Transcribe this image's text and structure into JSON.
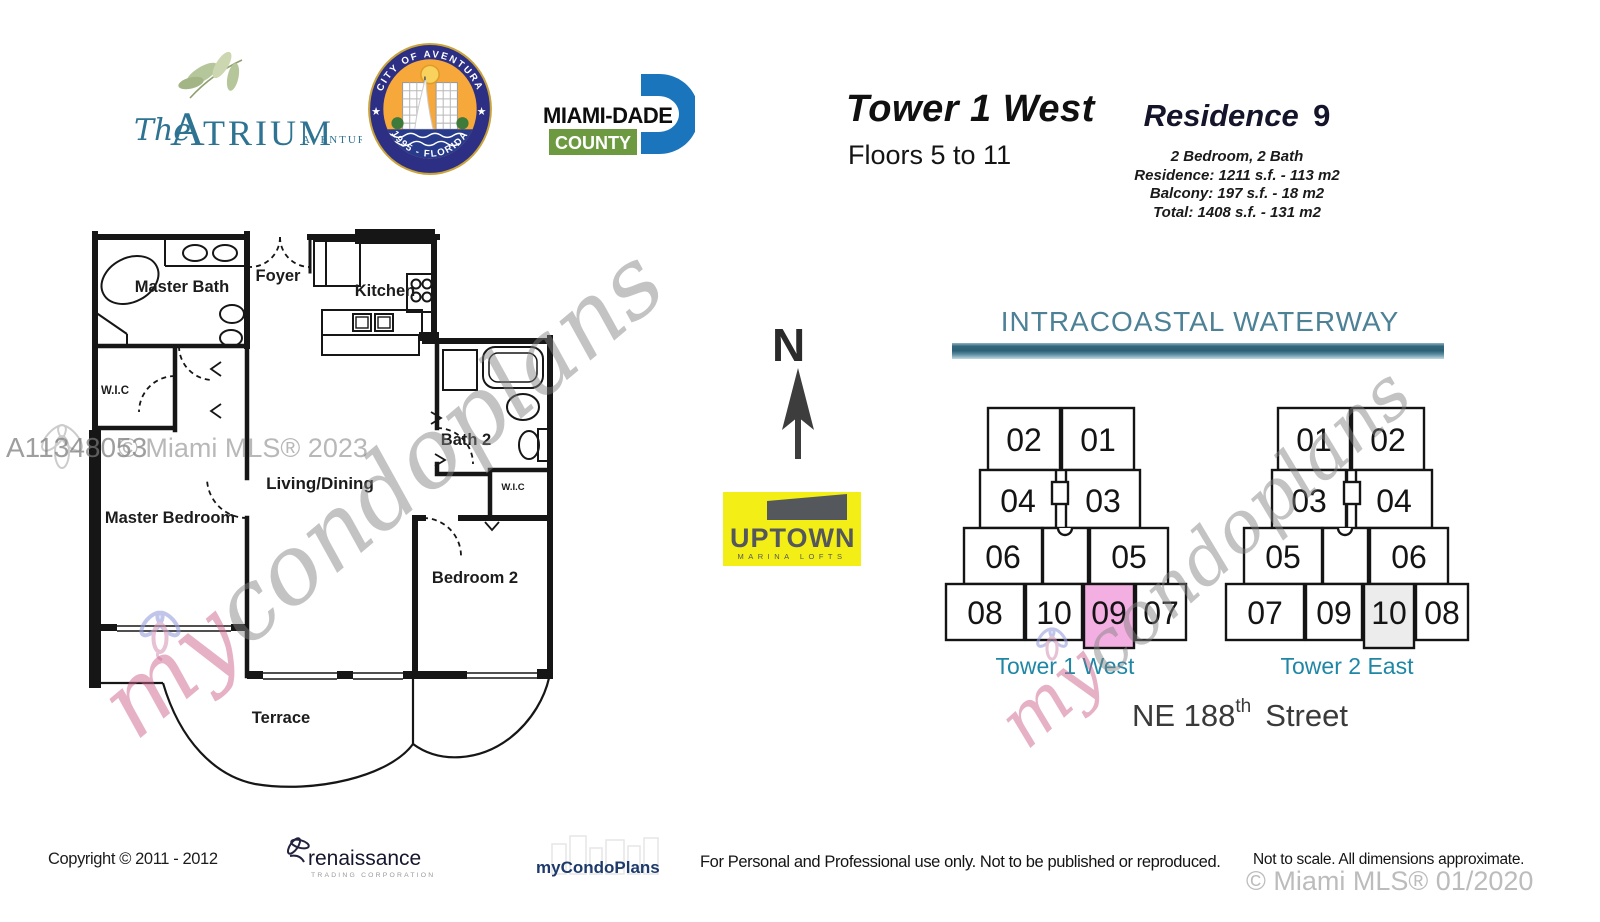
{
  "colors": {
    "teal": "#2e7391",
    "leaf_green": "#b5c79a",
    "heading_teal": "#4d8196",
    "tower_label_teal": "#1f87a5",
    "seal_navy": "#2c2f83",
    "seal_orange": "#f6a83a",
    "dade_blue": "#1b75bc",
    "county_green": "#6d9a41",
    "uptown_yellow": "#f3ee15",
    "uptown_gray": "#54585c",
    "highlight_pink": "#f3aee2",
    "shaded_gray": "#ececec",
    "brand_navy": "#1d3a6b",
    "wall": "#161616"
  },
  "header": {
    "atrium": {
      "script": "The",
      "initial": "A",
      "rest": "TRIUM",
      "city": "AVENTURA"
    },
    "seal": {
      "arc_top": "CITY OF AVENTURA",
      "arc_bottom": "1995 - FLORIDA",
      "star_left": "★",
      "star_right": "★"
    },
    "miami_dade": {
      "name": "MIAMI-DADE",
      "county": "COUNTY"
    },
    "tower_title": "Tower 1 West",
    "floors": "Floors 5 to 11",
    "residence_label": "Residence",
    "residence_number": "9",
    "residence_lines": [
      "2 Bedroom, 2 Bath",
      "Residence: 1211 s.f. - 113 m2",
      "Balcony: 197 s.f. - 18 m2",
      "Total: 1408 s.f. - 131 m2"
    ]
  },
  "floorplan": {
    "labels": {
      "master_bath": "Master Bath",
      "foyer": "Foyer",
      "kitchen": "Kitchen",
      "wic_master": "W.I.C",
      "bath2": "Bath 2",
      "wic_bedroom2": "W.I.C",
      "living_dining": "Living/Dining",
      "master_bedroom": "Master Bedroom",
      "bedroom2": "Bedroom 2",
      "terrace": "Terrace"
    }
  },
  "compass": {
    "north": "N"
  },
  "uptown": {
    "name": "UPTOWN",
    "tagline": "MARINA LOFTS"
  },
  "site": {
    "waterway": "INTRACOASTAL WATERWAY",
    "street_number": "NE 188",
    "street_ordinal": "th",
    "street_name": "Street",
    "tower1": {
      "label": "Tower 1 West",
      "units": [
        "02",
        "01",
        "04",
        "03",
        "06",
        "05",
        "08",
        "10",
        "09",
        "07"
      ],
      "highlighted_unit": "09"
    },
    "tower2": {
      "label": "Tower 2 East",
      "units": [
        "01",
        "02",
        "03",
        "04",
        "05",
        "06",
        "07",
        "09",
        "10",
        "08"
      ],
      "shaded_unit": "10"
    }
  },
  "watermarks": {
    "listing_id": "A11348053",
    "mls_2023": "© Miami MLS® 2023",
    "script_my": "my",
    "script_rest": "condoplans",
    "mls_2020": "© Miami MLS® 01/2020"
  },
  "footer": {
    "copyright": "Copyright © 2011 - 2012",
    "renaissance_name": "renaissance",
    "renaissance_sub": "TRADING CORPORATION",
    "brand": "myCondoPlans",
    "notice": "For Personal and Professional use only.  Not to be published or reproduced.",
    "disclaimer": "Not to scale.  All dimensions approximate."
  }
}
